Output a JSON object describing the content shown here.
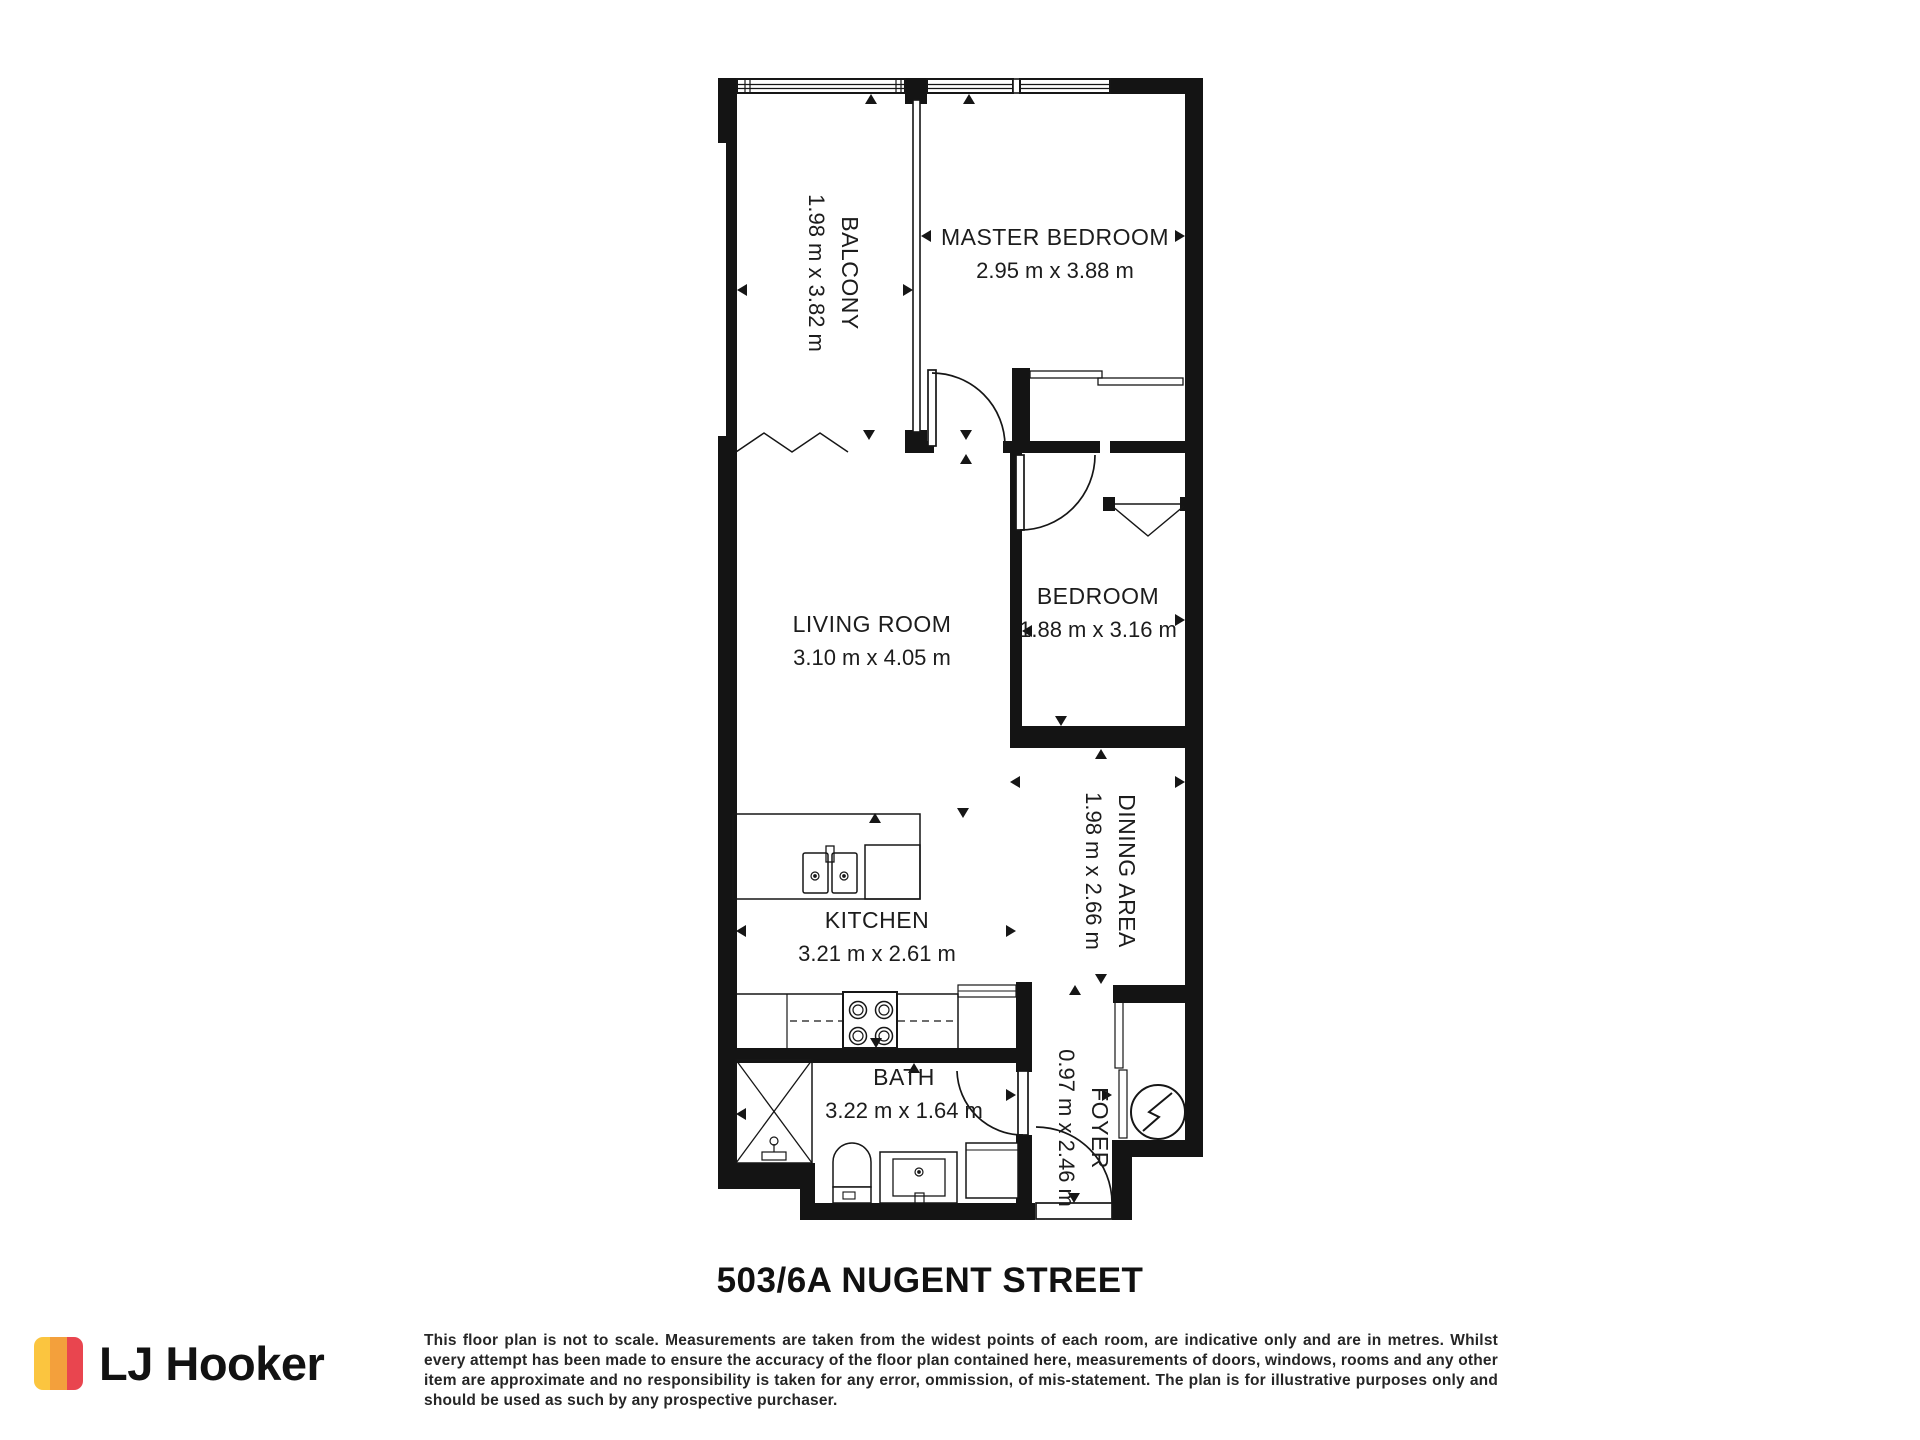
{
  "title": "503/6A NUGENT STREET",
  "plan": {
    "rooms": [
      {
        "id": "balcony",
        "name": "BALCONY",
        "dims": "1.98 m x 3.82 m"
      },
      {
        "id": "master-bedroom",
        "name": "MASTER BEDROOM",
        "dims": "2.95 m x 3.88 m"
      },
      {
        "id": "bedroom",
        "name": "BEDROOM",
        "dims": "1.88 m x 3.16 m"
      },
      {
        "id": "living-room",
        "name": "LIVING ROOM",
        "dims": "3.10 m x 4.05 m"
      },
      {
        "id": "dining-area",
        "name": "DINING AREA",
        "dims": "1.98 m x 2.66 m"
      },
      {
        "id": "kitchen",
        "name": "KITCHEN",
        "dims": "3.21 m x 2.61 m"
      },
      {
        "id": "bath",
        "name": "BATH",
        "dims": "3.22 m x 1.64 m"
      },
      {
        "id": "foyer",
        "name": "FOYER",
        "dims": "0.97 m x 2.46 m"
      }
    ]
  },
  "footer": {
    "logo_text": "LJ Hooker",
    "logo_colors": {
      "yellow": "#FBC53F",
      "orange": "#F3A03C",
      "red": "#E9454F"
    },
    "disclaimer": "This floor plan is not to scale. Measurements are taken from the widest points of each room, are indicative only and are in metres. Whilst every attempt has been made to ensure the accuracy of the floor plan contained here, measurements of doors, windows, rooms and any other item are approximate and no responsibility is taken for any error, ommission, of mis-statement. The plan is for illustrative purposes only and should be used as such by any prospective purchaser."
  }
}
